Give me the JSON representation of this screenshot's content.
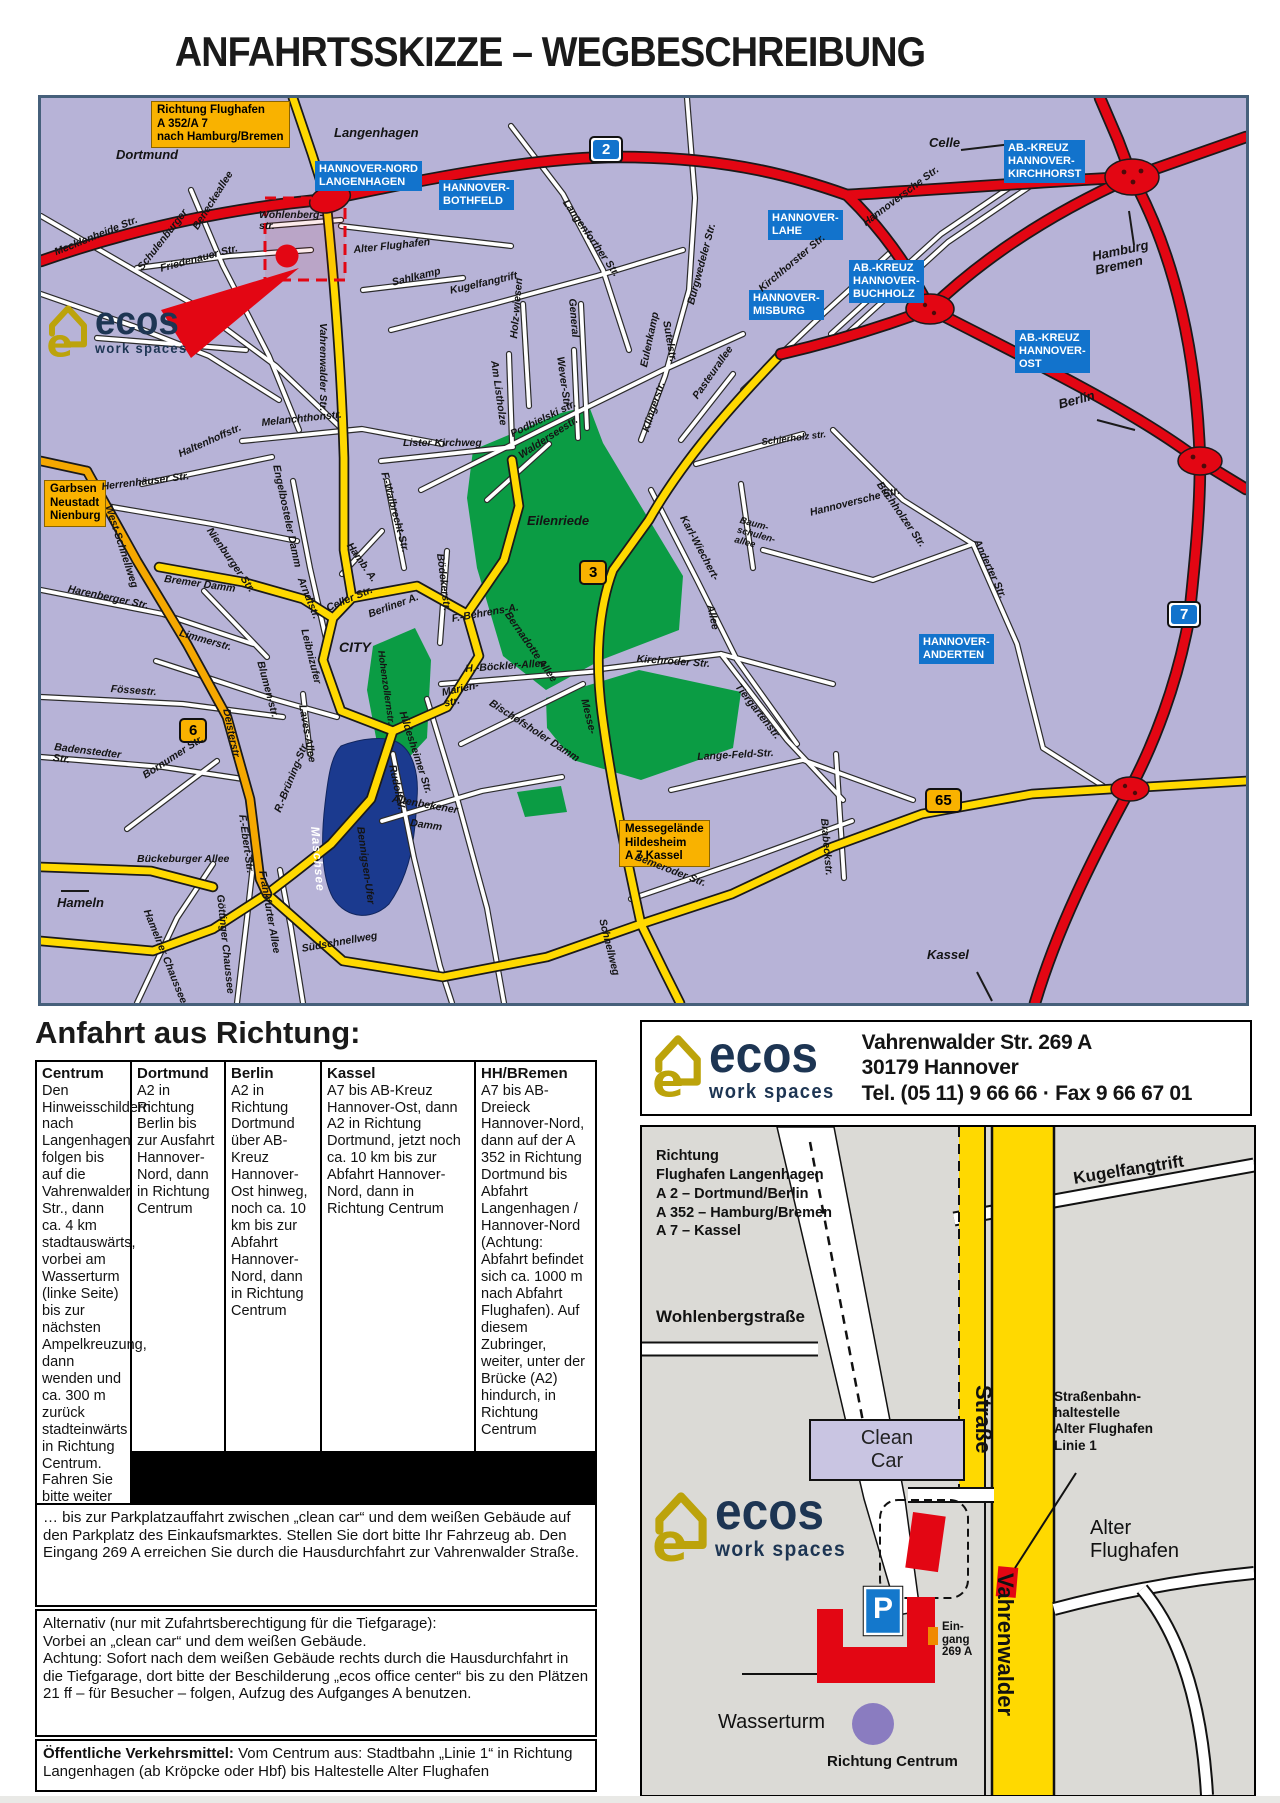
{
  "title": "ANFAHRTSSKIZZE – WEGBESCHREIBUNG",
  "brand": {
    "name": "ecos",
    "tagline": "work spaces"
  },
  "address": {
    "line1": "Vahrenwalder Str. 269 A",
    "line2": "30179 Hannover",
    "line3": "Tel. (05 11) 9 66 66 · Fax 9 66 67 01"
  },
  "main_map": {
    "blue_boxes": {
      "hannover_nord": "HANNOVER-NORD\nLANGENHAGEN",
      "bothfeld": "HANNOVER-\nBOTHFELD",
      "lahe": "HANNOVER-\nLAHE",
      "kirchhorst": "AB.-KREUZ\nHANNOVER-\nKIRCHHORST",
      "buchholz": "AB.-KREUZ\nHANNOVER-\nBUCHHOLZ",
      "misburg": "HANNOVER-\nMISBURG",
      "ost": "AB.-KREUZ\nHANNOVER-\nOST",
      "anderten": "HANNOVER-\nANDERTEN"
    },
    "orange_boxes": {
      "flughafen": "Richtung Flughafen\nA 352/A 7\nnach Hamburg/Bremen",
      "garbsen": "Garbsen\nNeustadt\nNienburg",
      "messegelaende": "Messegelände\nHildesheim\nA 7 Kassel"
    },
    "badges": {
      "b2": "2",
      "b3": "3",
      "b6": "6",
      "b7": "7",
      "b65": "65"
    },
    "streets": {
      "dortmund": "Dortmund",
      "langenhagen": "Langenhagen",
      "celle": "Celle",
      "hamburg_bremen": "Hamburg\nBremen",
      "berlin": "Berlin",
      "kassel": "Kassel",
      "hameln": "Hameln",
      "city": "CITY",
      "eilenriede": "Eilenriede",
      "maschsee": "Maschsee",
      "mecklenheide": "Mecklenheide Str.",
      "schulenburger": "Schulenburger",
      "beneckeallee": "Beneckeallee",
      "friedenauer": "Friedenauer Str.",
      "wohlenberg": "Wohlenberg-\nstr.",
      "alter_flughafen": "Alter Flughafen",
      "sahlkamp": "Sahlkamp",
      "vahrenwalder": "Vahrenwalder Str.",
      "langenforther": "Langenforther Str.",
      "burgwedeler": "Burgwedeler Str.",
      "kugelfangtrift": "Kugelfangtrift",
      "holzwiesen": "Holz-wiesen",
      "general": "General",
      "am_listholze": "Am Listholze",
      "wever": "Wever-Str.",
      "podbielski": "Podbielski str.",
      "sutelstr": "Sutelstr.",
      "eulenkamp": "Eulenkamp",
      "klingerstr": "Klingerstr.",
      "pasteurallee": "Pasteurallee",
      "kirchhorster": "Kirchhorster Str.",
      "hannoversche_n": "Hannoversche Str.",
      "hannoversche_s": "Hannoversche Str.",
      "schierholz": "Schierholz str.",
      "buchholzer": "Buchholzer Str.",
      "anderter": "Anderter Str.",
      "lister_kirchweg": "Lister Kirchweg",
      "walderseestr": "Walderseestr.",
      "melanchthonstr": "Melanchthonstr.",
      "haltenhoffstr": "Haltenhoffstr.",
      "herrenhaeuser": "Herrenhäuser Str.",
      "engelbosteler": "Engelbosteler Damm",
      "f_walbrecht": "F.-Walbrecht-Str.",
      "boedekerstr": "Bödekerstr.",
      "hamb_a": "Hamb. A.",
      "karl_wiechert": "Karl-Wiechert-",
      "kw_allee": "Allee",
      "baumschulen": "Baum-\nschulen-\nallee",
      "west_schnellweg": "West-Schnellweg",
      "bremer_damm": "Bremer Damm",
      "nienburger": "Nienburger Str.",
      "harenberger": "Harenberger Str.",
      "limmerstr": "Limmerstr.",
      "foessestr": "Fössestr.",
      "badenstedter": "Badenstedter\nStr.",
      "bornumer": "Bornumer Str.",
      "bueckeburger": "Bückeburger Allee",
      "f_ebert": "F.-Ebert-Str.",
      "deisterstr": "Deisterstr.",
      "blumenstr": "Blumen-str.",
      "arndtstr": "Arndtstr.",
      "celler_str": "Celler Str.",
      "berliner_a": "Berliner A.",
      "leibnizufer": "Leibnizufer",
      "laves_allee": "Laves-Allee",
      "r_bruening": "R.-Brüning-Str.",
      "marienstr": "Marien-\nstr.",
      "hildesheimer": "Hildesheimer Str.",
      "rudolf_v": "Rudolf-V.-",
      "bennigsen": "Bennigsen-Ufer",
      "altenbekener": "Altenbekener",
      "altenbekener_damm": "Damm",
      "suedschnellweg": "Südschnellweg",
      "goettinger": "Göttinger Chaussee",
      "hamelner": "Hamelner Chaussee",
      "frankfurter": "Frankfurter Allee",
      "schnellweg": "Schnellweg",
      "bemeroder": "Bemeroder Str.",
      "brabeckstr": "Brabeckstr.",
      "tiergartenstr": "Tiergartenstr.",
      "kirchroeder": "Kirchröder Str.",
      "lange_feld": "Lange-Feld-Str.",
      "h_boeckler": "H.-Böckler-Allee",
      "bischofsholer": "Bischofsholer Damm",
      "messe": "Messe-",
      "f_behrens": "F.-Behrens-A.",
      "hohenzollern": "Hohenzollernstr.",
      "bernadotte": "Bernadotte Allee"
    }
  },
  "directions": {
    "heading": "Anfahrt aus Richtung:",
    "columns": [
      {
        "header": "Dortmund",
        "text": "A2 in Richtung Berlin bis zur Ausfahrt Hannover-Nord, dann in Richtung Centrum"
      },
      {
        "header": "Berlin",
        "text": "A2 in Richtung Dortmund über AB-Kreuz Hannover-Ost hinweg, noch ca. 10 km bis zur Abfahrt Hannover-Nord, dann in Richtung Centrum"
      },
      {
        "header": "Kassel",
        "text": "A7 bis AB-Kreuz Hannover-Ost, dann A2 in Richtung Dortmund, jetzt noch ca. 10 km bis zur Abfahrt Hannover-Nord, dann in Richtung Centrum"
      },
      {
        "header": "HH/BRemen",
        "text": "A7 bis AB-Dreieck Hannover-Nord, dann auf der A 352 in Richtung Dortmund bis Abfahrt Langenhagen / Hannover-Nord (Achtung: Abfahrt befindet sich ca. 1000 m nach Abfahrt Flughafen). Auf diesem Zubringer, weiter, unter der Brücke (A2) hindurch, in Richtung Centrum"
      },
      {
        "header": "Centrum",
        "text": "Den Hinweisschildern nach Langenhagen folgen bis auf die Vahrenwalder Str., dann ca. 4 km stadtauswärts, vorbei am Wasserturm (linke Seite) bis zur nächsten Ampelkreuzung, dann wenden und ca. 300 m zurück stadteinwärts in Richtung Centrum. Fahren Sie bitte weiter …"
      }
    ],
    "note": "Jetzt befinden Sie sich auf der Vahrenwalder Str.,\nfahren Sie bitte 1 km weiter stadteinwärts …",
    "para_parkplatz": "… bis zur Parkplatzauffahrt zwischen „clean car“ und dem weißen Gebäude auf den Parkplatz des Einkaufsmarktes. Stellen Sie dort bitte Ihr Fahrzeug ab. Den Eingang 269 A erreichen Sie durch die Hausdurchfahrt zur Vahrenwalder Straße.",
    "para_alternativ": "Alternativ (nur mit Zufahrtsberechtigung für die Tiefgarage):\nVorbei an „clean car“ und dem weißen Gebäude.\nAchtung: Sofort nach dem weißen Gebäude rechts durch die Hausdurchfahrt in die Tiefgarage, dort bitte der Beschilderung „ecos office center“ bis zu den Plätzen 21 ff – für Besucher – folgen, Aufzug des Aufganges A benutzen.",
    "transport_bold": "Öffentliche Verkehrsmittel:",
    "transport_text": "Vom Centrum aus: Stadtbahn „Linie 1“ in Richtung Langenhagen (ab Kröpcke oder Hbf) bis Haltestelle Alter Flughafen"
  },
  "detail": {
    "richtung_block": "Richtung\nFlughafen Langenhagen\nA 2 – Dortmund/Berlin\nA 352 – Hamburg/Bremen\nA 7 – Kassel",
    "kugelfangtrift": "Kugelfangtrift",
    "wohlenbergstrasse": "Wohlenbergstraße",
    "clean_car": "Clean\nCar",
    "tram_stop": "Straßenbahn-\nhaltestelle\nAlter Flughafen\nLinie 1",
    "alter_flughafen": "Alter\nFlughafen",
    "strasse": "Straße",
    "vahrenwalder": "Vahrenwalder",
    "parking": "P",
    "eingang": "Ein-\ngang\n269 A",
    "wasserturm": "Wasserturm",
    "richtung_centrum": "Richtung Centrum"
  }
}
